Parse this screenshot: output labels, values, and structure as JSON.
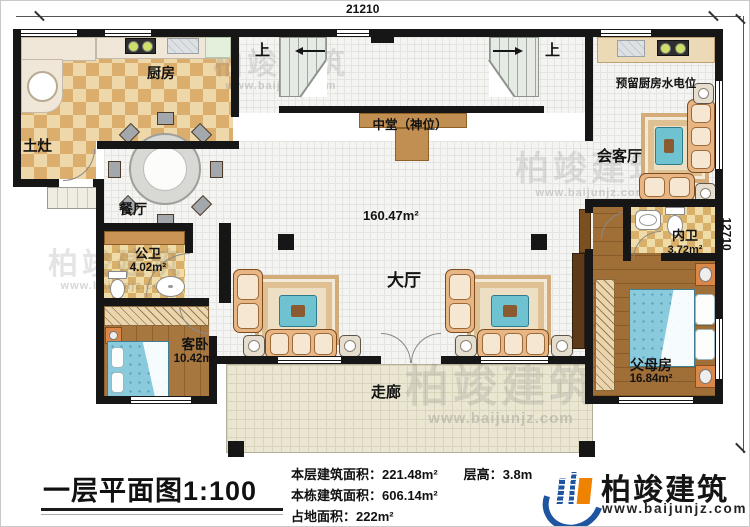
{
  "dimensions": {
    "top": "21210",
    "right": "12710"
  },
  "labels": {
    "kitchen": "厨房",
    "earth_stove": "土灶",
    "dining": "餐厅",
    "public_bath": "公卫",
    "public_bath_area": "4.02m²",
    "guest_room": "客卧",
    "guest_room_area": "10.42m²",
    "shrine": "中堂（神位）",
    "hall": "大厅",
    "hall_area": "160.47m²",
    "corridor": "走廊",
    "reserved_kitchen": "预留厨房水电位",
    "reception": "会客厅",
    "inner_bath": "内卫",
    "inner_bath_area": "3.72m²",
    "parents_room": "父母房",
    "parents_room_area": "16.84m²",
    "stair_up_left": "上",
    "stair_up_right": "上"
  },
  "footer": {
    "title": "一层平面图",
    "scale": "1:100",
    "stats": [
      {
        "label": "本层建筑面积：",
        "value": "221.48m²"
      },
      {
        "label": "层高：",
        "value": "3.8m"
      },
      {
        "label": "本栋建筑面积：",
        "value": "606.14m²"
      },
      {
        "label": "占地面积：",
        "value": "222m²"
      }
    ],
    "brand_name": "柏竣建筑",
    "brand_url": "www.baijunjz.com"
  },
  "watermark": {
    "name": "柏竣建筑",
    "url": "www.baijunjz.com"
  },
  "colors": {
    "wall": "#161616",
    "brand_blue": "#1f55a0",
    "brand_orange": "#ef8200",
    "bed": "#8acadd",
    "sofa": "#e8b685",
    "altar": "#c28f52"
  }
}
